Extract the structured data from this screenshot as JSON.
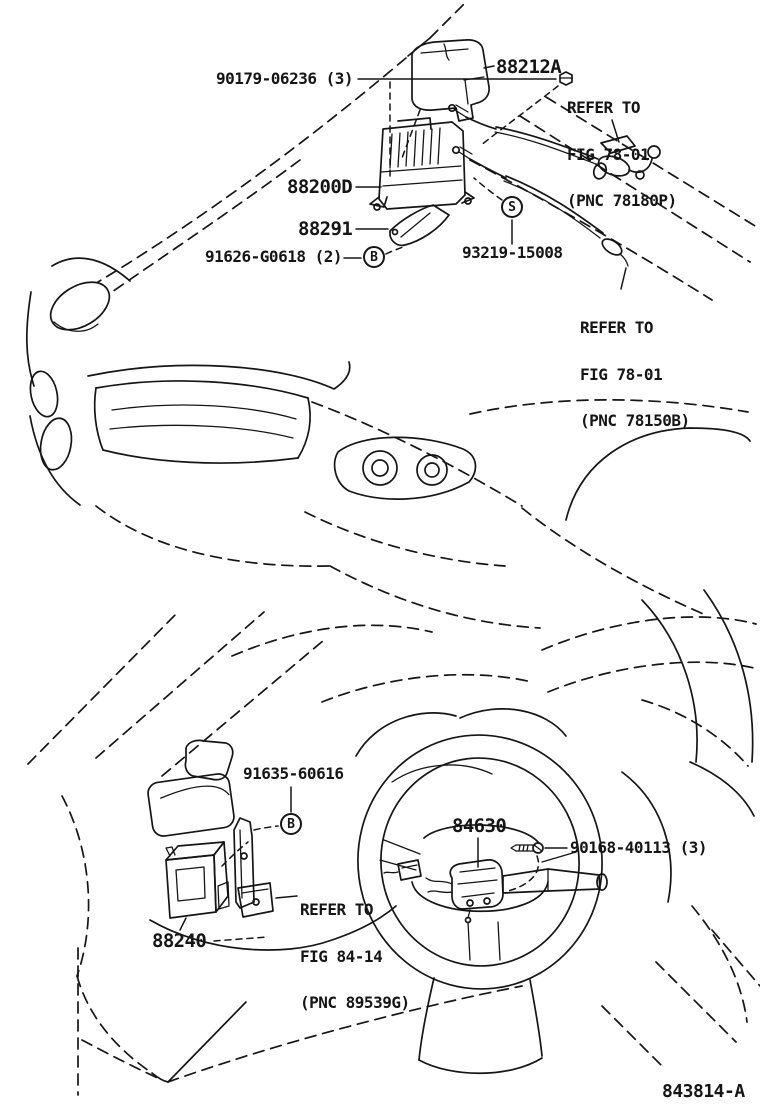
{
  "diagram": {
    "doc_number": "843814-A",
    "parts": {
      "nut": "90179-06236 (3)",
      "cover": "88212A",
      "actuator": "88200D",
      "bracket": "88291",
      "bolt_upper": "91626-G0618 (2)",
      "clip": "93219-15008",
      "bolt_lower": "91635-60616",
      "switch": "84630",
      "screw": "90168-40113 (3)",
      "module": "88240"
    },
    "references": {
      "throttle_cable": [
        "REFER TO",
        "FIG 78-01",
        "(PNC 78180P)"
      ],
      "accel_cable": [
        "REFER TO",
        "FIG 78-01",
        "(PNC 78150B)"
      ],
      "spiral_cable": [
        "REFER TO",
        "FIG 84-14",
        "(PNC 89539G)"
      ]
    },
    "markers": {
      "bolt_upper": "B",
      "clip": "S",
      "bolt_lower": "B"
    },
    "colors": {
      "line": "#151515",
      "background": "#ffffff"
    }
  }
}
